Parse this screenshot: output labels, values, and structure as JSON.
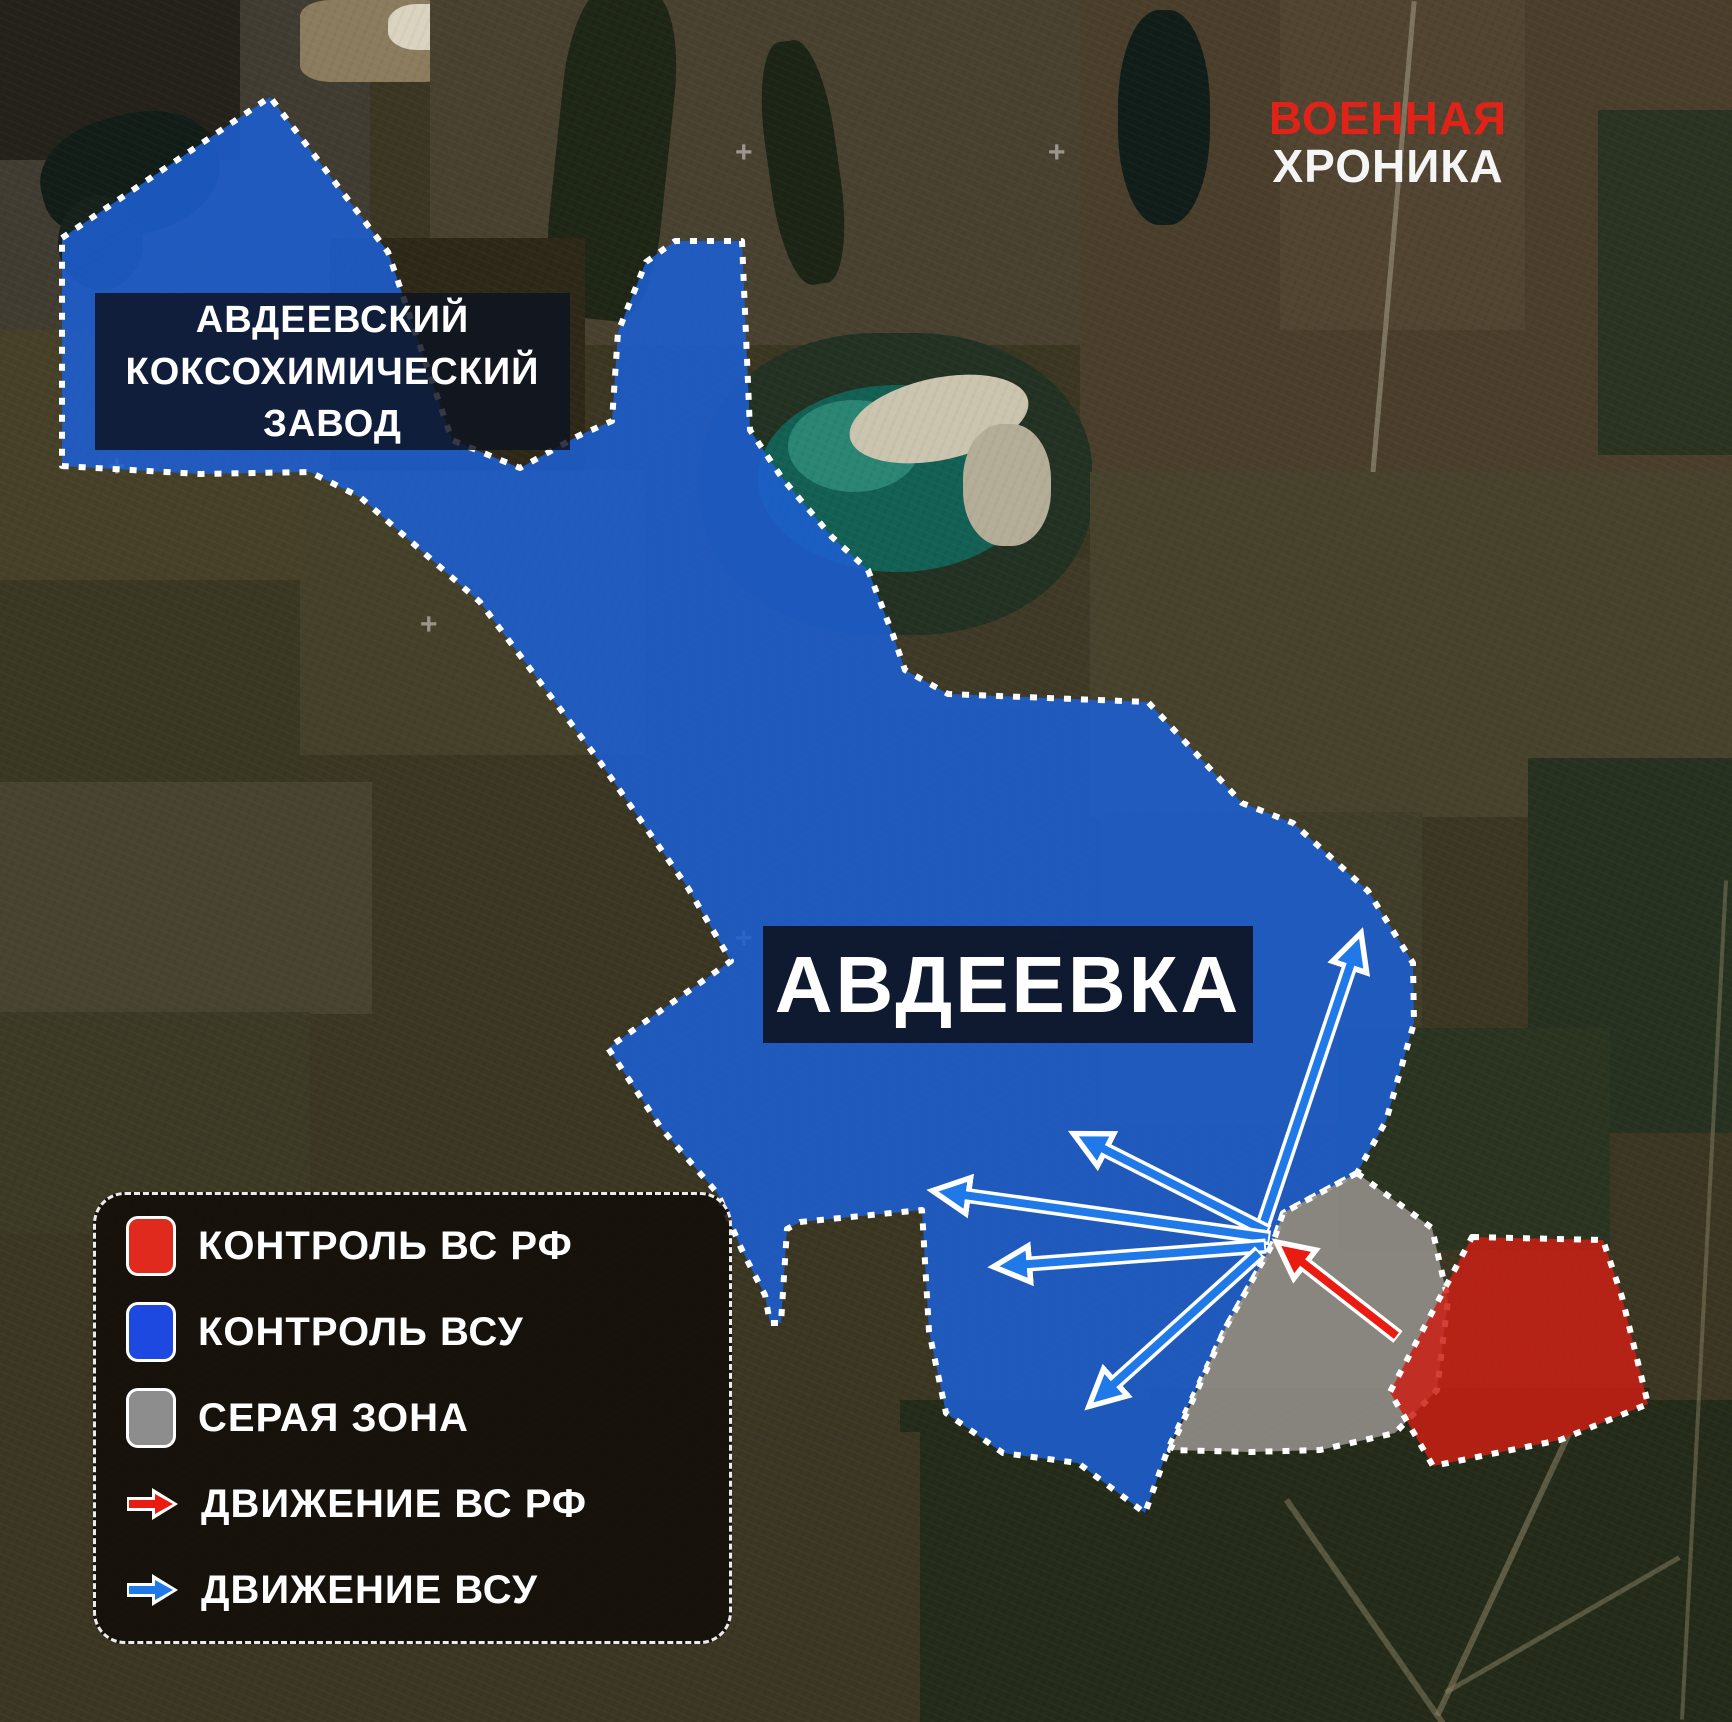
{
  "brand": {
    "line1": "ВОЕННАЯ",
    "line2": "ХРОНИКА"
  },
  "labels": {
    "plant": {
      "line1": "АВДЕЕВСКИЙ",
      "line2": "КОКСОХИМИЧЕСКИЙ",
      "line3": "ЗАВОД"
    },
    "city": "АВДЕЕВКА"
  },
  "legend": {
    "items": [
      {
        "type": "swatch",
        "color_key": "red_control",
        "label": "КОНТРОЛЬ ВС РФ"
      },
      {
        "type": "swatch",
        "color_key": "blue_control",
        "label": "КОНТРОЛЬ ВСУ"
      },
      {
        "type": "swatch",
        "color_key": "gray_zone",
        "label": "СЕРАЯ ЗОНА"
      },
      {
        "type": "arrow",
        "color_key": "red_movement",
        "label": "ДВИЖЕНИЕ ВС РФ"
      },
      {
        "type": "arrow",
        "color_key": "blue_movement",
        "label": "ДВИЖЕНИЕ ВСУ"
      }
    ]
  },
  "colors": {
    "red_control": "#e02a1e",
    "blue_control": "#1d49e0",
    "gray_zone": "#8d8d8d",
    "red_movement": "#ea1c12",
    "blue_movement": "#2079e8",
    "zone_blue_fill": "rgba(29,95,210,0.88)",
    "zone_gray_fill": "rgba(146,142,138,0.9)",
    "zone_red_fill": "rgba(203,30,20,0.85)",
    "zone_border": "#ffffff",
    "brand_red": "#e02318",
    "brand_white": "#f5f5f5"
  },
  "map": {
    "zones": [
      {
        "name": "zone-vsu-control",
        "fill_key": "zone_blue_fill",
        "points": [
          [
            62,
            238
          ],
          [
            270,
            97
          ],
          [
            388,
            252
          ],
          [
            452,
            440
          ],
          [
            520,
            468
          ],
          [
            578,
            436
          ],
          [
            612,
            421
          ],
          [
            618,
            332
          ],
          [
            646,
            262
          ],
          [
            675,
            241
          ],
          [
            742,
            241
          ],
          [
            750,
            430
          ],
          [
            782,
            478
          ],
          [
            832,
            537
          ],
          [
            868,
            570
          ],
          [
            893,
            635
          ],
          [
            905,
            670
          ],
          [
            948,
            694
          ],
          [
            1148,
            702
          ],
          [
            1242,
            803
          ],
          [
            1293,
            823
          ],
          [
            1368,
            891
          ],
          [
            1413,
            963
          ],
          [
            1414,
            1023
          ],
          [
            1386,
            1121
          ],
          [
            1357,
            1173
          ],
          [
            1283,
            1213
          ],
          [
            1273,
            1243
          ],
          [
            1226,
            1327
          ],
          [
            1168,
            1449
          ],
          [
            1145,
            1513
          ],
          [
            1078,
            1463
          ],
          [
            1003,
            1453
          ],
          [
            946,
            1413
          ],
          [
            929,
            1331
          ],
          [
            922,
            1210
          ],
          [
            800,
            1222
          ],
          [
            787,
            1229
          ],
          [
            781,
            1323
          ],
          [
            770,
            1323
          ],
          [
            765,
            1295
          ],
          [
            748,
            1262
          ],
          [
            741,
            1248
          ],
          [
            718,
            1194
          ],
          [
            661,
            1128
          ],
          [
            608,
            1048
          ],
          [
            731,
            961
          ],
          [
            688,
            888
          ],
          [
            600,
            762
          ],
          [
            480,
            602
          ],
          [
            360,
            497
          ],
          [
            310,
            472
          ],
          [
            200,
            474
          ],
          [
            62,
            466
          ]
        ]
      },
      {
        "name": "zone-gray",
        "fill_key": "zone_gray_fill",
        "points": [
          [
            1357,
            1173
          ],
          [
            1432,
            1228
          ],
          [
            1448,
            1300
          ],
          [
            1437,
            1390
          ],
          [
            1395,
            1433
          ],
          [
            1320,
            1450
          ],
          [
            1250,
            1452
          ],
          [
            1170,
            1450
          ],
          [
            1226,
            1327
          ],
          [
            1273,
            1243
          ],
          [
            1283,
            1213
          ]
        ]
      },
      {
        "name": "zone-rf-control",
        "fill_key": "zone_red_fill",
        "points": [
          [
            1472,
            1237
          ],
          [
            1603,
            1240
          ],
          [
            1622,
            1297
          ],
          [
            1648,
            1404
          ],
          [
            1560,
            1440
          ],
          [
            1433,
            1466
          ],
          [
            1390,
            1392
          ]
        ]
      }
    ],
    "arrows": [
      {
        "name": "vsu-arrow-north",
        "color_key": "blue_movement",
        "from": [
          1262,
          1228
        ],
        "to": [
          1358,
          942
        ]
      },
      {
        "name": "vsu-arrow-northwest",
        "color_key": "blue_movement",
        "from": [
          1268,
          1232
        ],
        "to": [
          1082,
          1138
        ]
      },
      {
        "name": "vsu-arrow-west-up",
        "color_key": "blue_movement",
        "from": [
          1270,
          1238
        ],
        "to": [
          942,
          1192
        ]
      },
      {
        "name": "vsu-arrow-west",
        "color_key": "blue_movement",
        "from": [
          1266,
          1246
        ],
        "to": [
          1003,
          1266
        ]
      },
      {
        "name": "vsu-arrow-southwest",
        "color_key": "blue_movement",
        "from": [
          1260,
          1252
        ],
        "to": [
          1096,
          1400
        ]
      },
      {
        "name": "rf-arrow-advance",
        "color_key": "red_movement",
        "from": [
          1398,
          1337
        ],
        "to": [
          1284,
          1248
        ]
      }
    ]
  }
}
